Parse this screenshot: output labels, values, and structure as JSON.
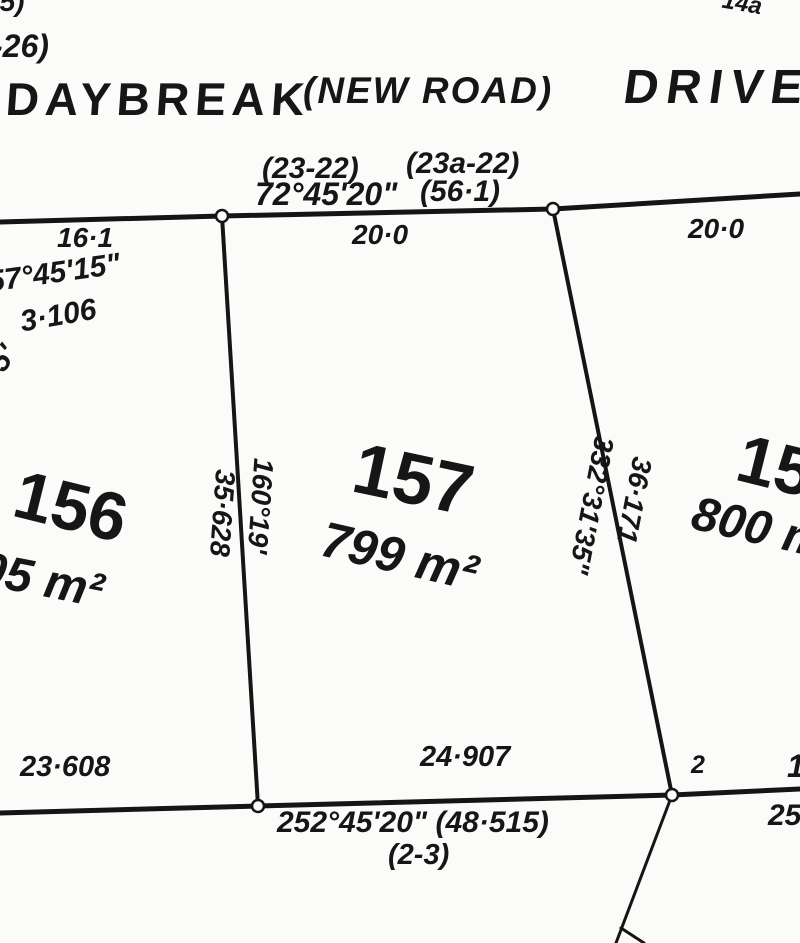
{
  "road": {
    "name": "DAYBREAK",
    "qualifier": "(NEW ROAD)",
    "suffix": "DRIVE"
  },
  "road_frontage": {
    "ref_left": "(23-22)",
    "bearing": "72°45'20\"",
    "ref_right": "(23a-22)",
    "total_distance": "(56·1)",
    "dist_156": "16·1",
    "dist_157": "20·0",
    "dist_158": "20·0"
  },
  "lots": {
    "lot156": {
      "number": "156",
      "area": "805 m²"
    },
    "lot157": {
      "number": "157",
      "area": "799 m²"
    },
    "lot158": {
      "number": "158",
      "area": "800 m²"
    }
  },
  "boundaries": {
    "west": {
      "bearing": "160°19'",
      "distance": "35·628"
    },
    "east": {
      "bearing": "332°31'35\"",
      "distance": "36·171"
    },
    "rear": {
      "dist_156": "23·608",
      "dist_157": "24·907",
      "bearing_and_total": "252°45'20\"  (48·515)",
      "ref": "(2-3)"
    }
  },
  "edge_fragments": {
    "top_left_line1": "55)",
    "top_left_line2": "-26)",
    "top_right": "14a",
    "left_bearing": "57°45'15\"",
    "left_distance": "3·106",
    "left_rotated_bearing": "45'",
    "corner_mark_label": "2",
    "bottom_right_distance": "25",
    "bottom_right_upper": "1"
  }
}
